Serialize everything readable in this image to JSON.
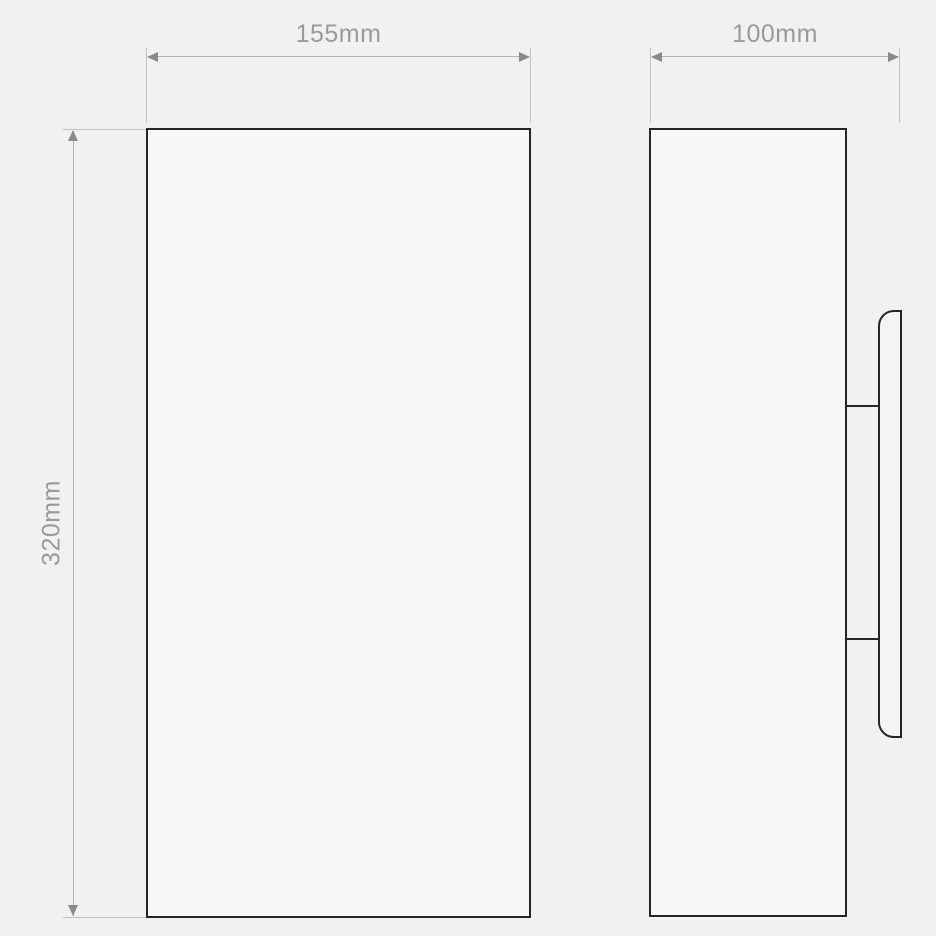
{
  "drawing": {
    "title": "wall-light technical dimension drawing",
    "views": {
      "front": {
        "name": "front elevation view"
      },
      "side": {
        "name": "side profile view with wall mounting plate"
      }
    },
    "dimensions": {
      "width": {
        "label": "155mm",
        "value": 155,
        "unit": "mm",
        "applies_to": "front view width"
      },
      "depth": {
        "label": "100mm",
        "value": 100,
        "unit": "mm",
        "applies_to": "side view depth including mounting plate"
      },
      "height": {
        "label": "320mm",
        "value": 320,
        "unit": "mm",
        "applies_to": "front view height"
      }
    },
    "colors": {
      "background": "#f1f1f2",
      "body_fill": "#f7f7f8",
      "outline": "#252525",
      "dimension_line": "#b3b3b5",
      "dimension_text": "#9a9a9c",
      "arrow": "#8a8a8c"
    }
  }
}
